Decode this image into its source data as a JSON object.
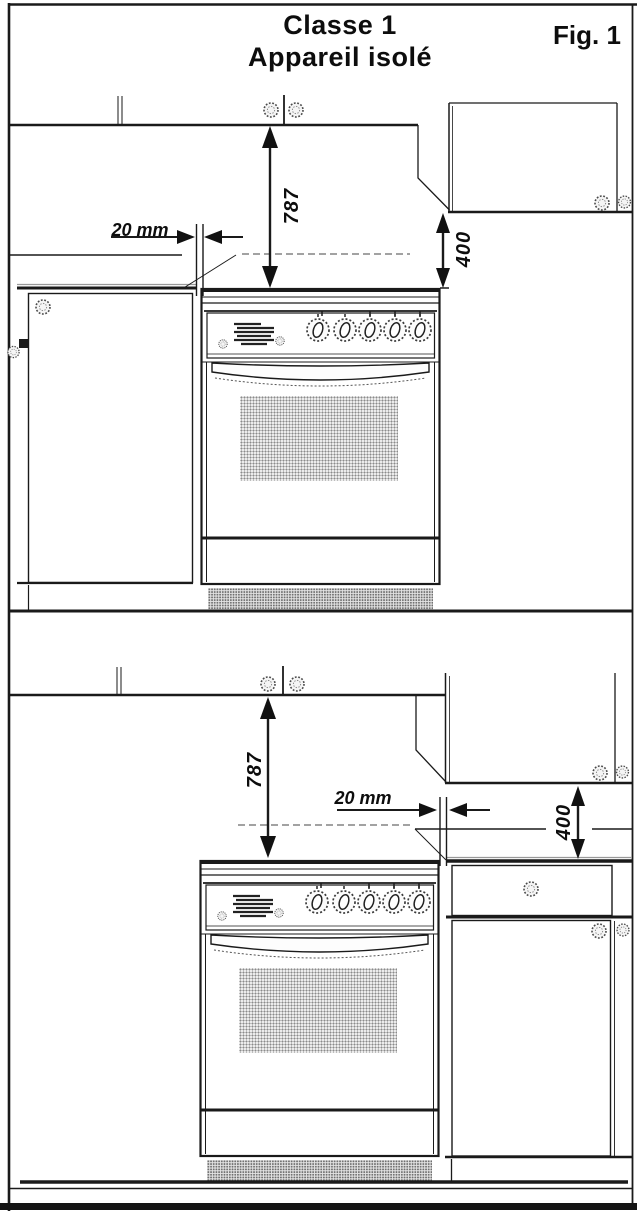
{
  "title": {
    "line1": "Classe 1",
    "line2": "Appareil isolé"
  },
  "figure_label": "Fig. 1",
  "diagrams": {
    "top": {
      "description": "stove isolated, base cabinet on left",
      "hob_to_wall_cabinet_clearance": "787",
      "wall_cabinet_to_worktop_clearance": "400",
      "side_gap": "20 mm"
    },
    "bottom": {
      "description": "stove isolated, base cabinet on right",
      "hob_to_wall_cabinet_clearance": "787",
      "wall_cabinet_to_worktop_clearance": "400",
      "side_gap": "20 mm"
    }
  },
  "colors": {
    "line": "#1a1a1a",
    "background": "#ffffff",
    "halftone": "#8b8b8b"
  }
}
